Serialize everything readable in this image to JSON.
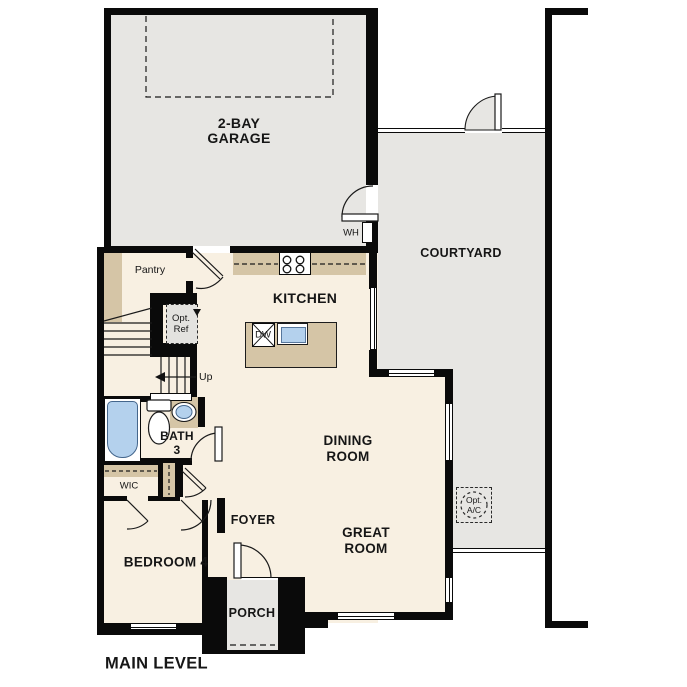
{
  "title": {
    "level": "MAIN LEVEL"
  },
  "rooms": {
    "garage": {
      "line1": "2-BAY",
      "line2": "GARAGE"
    },
    "courtyard": {
      "label": "COURTYARD"
    },
    "kitchen": {
      "label": "KITCHEN"
    },
    "dining": {
      "line1": "DINING",
      "line2": "ROOM"
    },
    "great": {
      "line1": "GREAT",
      "line2": "ROOM"
    },
    "bedroom4": {
      "label": "BEDROOM 4"
    },
    "bath3": {
      "line1": "BATH",
      "line2": "3"
    },
    "foyer": {
      "label": "FOYER"
    },
    "porch": {
      "label": "PORCH"
    },
    "wic": {
      "label": "WIC"
    },
    "pantry": {
      "label": "Pantry"
    }
  },
  "annotations": {
    "water_heater": "WH",
    "dishwasher": "DW",
    "stairs_up": "Up",
    "opt_ref": {
      "line1": "Opt.",
      "line2": "Ref"
    },
    "opt_ac": {
      "line1": "Opt.",
      "line2": "A/C"
    }
  },
  "colors": {
    "wall": "#0a0a0a",
    "floor": "#f8f0e2",
    "hard": "#e7e6e3",
    "wood": "#d5c5a6",
    "blue": "#b4d1ed",
    "optfill": "#e3e2df",
    "line": "#1a1a1a"
  }
}
